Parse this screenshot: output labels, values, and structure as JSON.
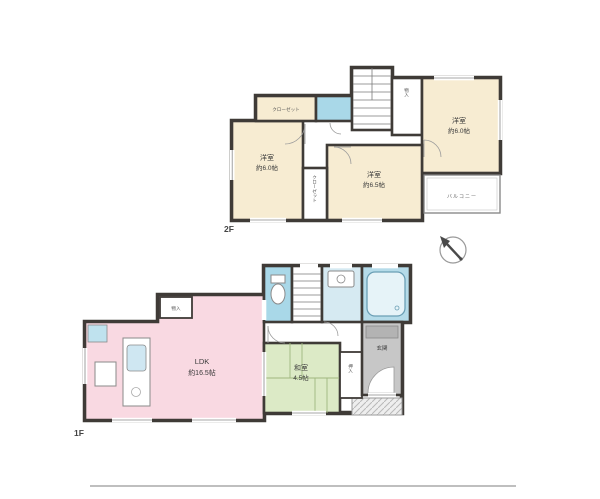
{
  "plan_type": "madori-floorplan",
  "floor_2f": {
    "floor_label": "2F",
    "rooms": {
      "left": {
        "name": "洋室",
        "size": "約6.0帖"
      },
      "middle": {
        "name": "洋室",
        "size": "約6.5帖"
      },
      "right": {
        "name": "洋室",
        "size": "約6.0帖"
      }
    },
    "closet_top": "クローゼット",
    "closet_strip": "クローゼット",
    "storage_right": "物入",
    "balcony": "バルコニー"
  },
  "floor_1f": {
    "floor_label": "1F",
    "ldk": {
      "name": "LDK",
      "size": "約16.5帖"
    },
    "washitsu": {
      "name": "和室",
      "size": "4.5帖"
    },
    "entrance": "玄関",
    "oshiire": "押入",
    "storage_nook": "物入"
  },
  "colors": {
    "bedroom_cream": "#f7ecd2",
    "ldk_pink": "#f9d9e2",
    "tatami_green": "#dceac6",
    "toilet_blue": "#a9d8e8",
    "washroom_blue": "#d6eaf2",
    "bath_blue": "#b5dbe9",
    "entrance_gray": "#c7c7c7",
    "wall_dark": "#3f3b37"
  }
}
